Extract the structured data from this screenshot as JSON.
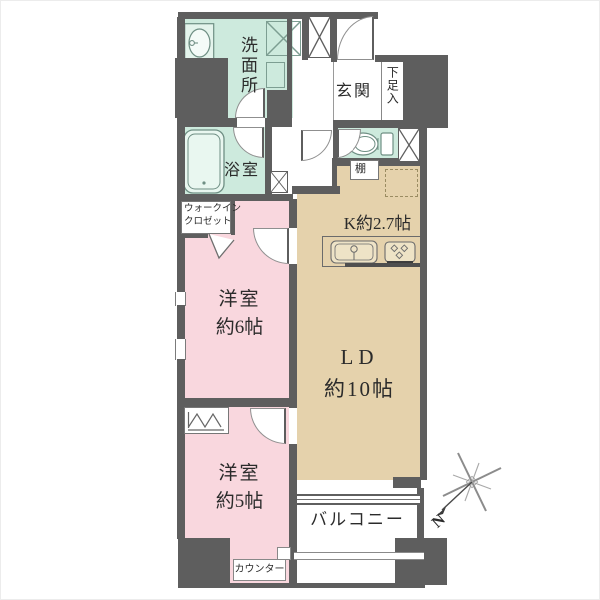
{
  "plan": {
    "title": "2LDK floor plan",
    "colors": {
      "wall": "#5e5e5e",
      "wet": "#cdeadd",
      "bed": "#f9d7de",
      "ld": "#e5d2ac",
      "line": "#777777"
    },
    "rooms": {
      "washroom": {
        "name": "洗面所"
      },
      "bathroom": {
        "name": "浴室"
      },
      "entrance": {
        "name": "玄関"
      },
      "shoe_box": {
        "name": "下足入"
      },
      "shelf": {
        "name": "棚"
      },
      "kitchen": {
        "name": "K約2.7帖"
      },
      "walk_in_closet": {
        "line1": "ウォークイン",
        "line2": "クロゼット"
      },
      "bedroom_6": {
        "line1": "洋室",
        "line2": "約6帖"
      },
      "living_dining": {
        "line1": "LD",
        "line2": "約10帖"
      },
      "bedroom_5": {
        "line1": "洋室",
        "line2": "約5帖"
      },
      "balcony": {
        "name": "バルコニー"
      },
      "counter": {
        "name": "カウンター"
      }
    },
    "compass": {
      "north_label": "N"
    },
    "icons": {
      "sink": "washbasin-icon",
      "washer_pan": "washing-machine-pan-icon",
      "bathtub": "bathtub-icon",
      "toilet": "toilet-icon",
      "kitchen_unit": "kitchen-sink-stove-icon",
      "refrigerator": "refrigerator-space-dashed",
      "hanger": "closet-hanger-icon",
      "shaft": "pipe-shaft-x-icon",
      "compass": "compass-rose-icon"
    }
  }
}
